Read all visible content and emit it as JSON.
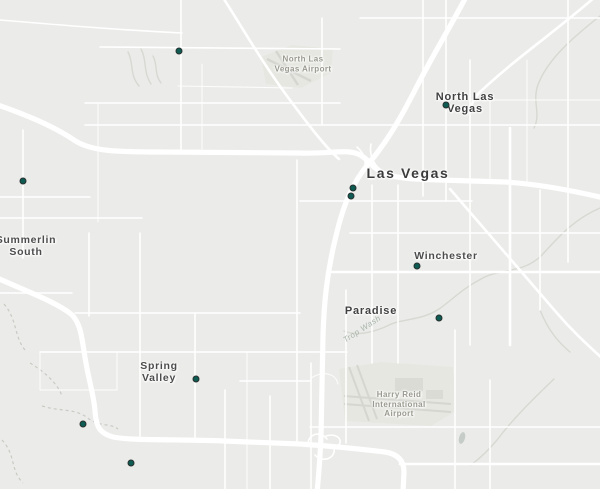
{
  "map": {
    "labels": {
      "city_major": "Las Vegas",
      "north_las_vegas": "North Las\nVegas",
      "summerlin_south": "Summerlin\nSouth",
      "spring_valley": "Spring\nValley",
      "winchester": "Winchester",
      "paradise": "Paradise",
      "north_lv_airport": "North Las\nVegas Airport",
      "harry_reid_airport": "Harry Reid\nInternational\nAirport",
      "trop_wash": "Trop Wash"
    },
    "colors": {
      "background": "#ebebe9",
      "road": "#ffffff",
      "airport_fill": "#e6e7e1",
      "runway": "#d5d6d0",
      "wash": "#d7d8d2",
      "marker_fill": "#0d5b52",
      "marker_ring": "#28312e",
      "label_dark": "#3b3b3b",
      "label_airport": "#99998f"
    },
    "markers": [
      {
        "x": 179,
        "y": 51
      },
      {
        "x": 446,
        "y": 105
      },
      {
        "x": 23,
        "y": 181
      },
      {
        "x": 353,
        "y": 188
      },
      {
        "x": 351,
        "y": 196
      },
      {
        "x": 417,
        "y": 266
      },
      {
        "x": 439,
        "y": 318
      },
      {
        "x": 196,
        "y": 379
      },
      {
        "x": 83,
        "y": 424
      },
      {
        "x": 131,
        "y": 463
      }
    ]
  }
}
